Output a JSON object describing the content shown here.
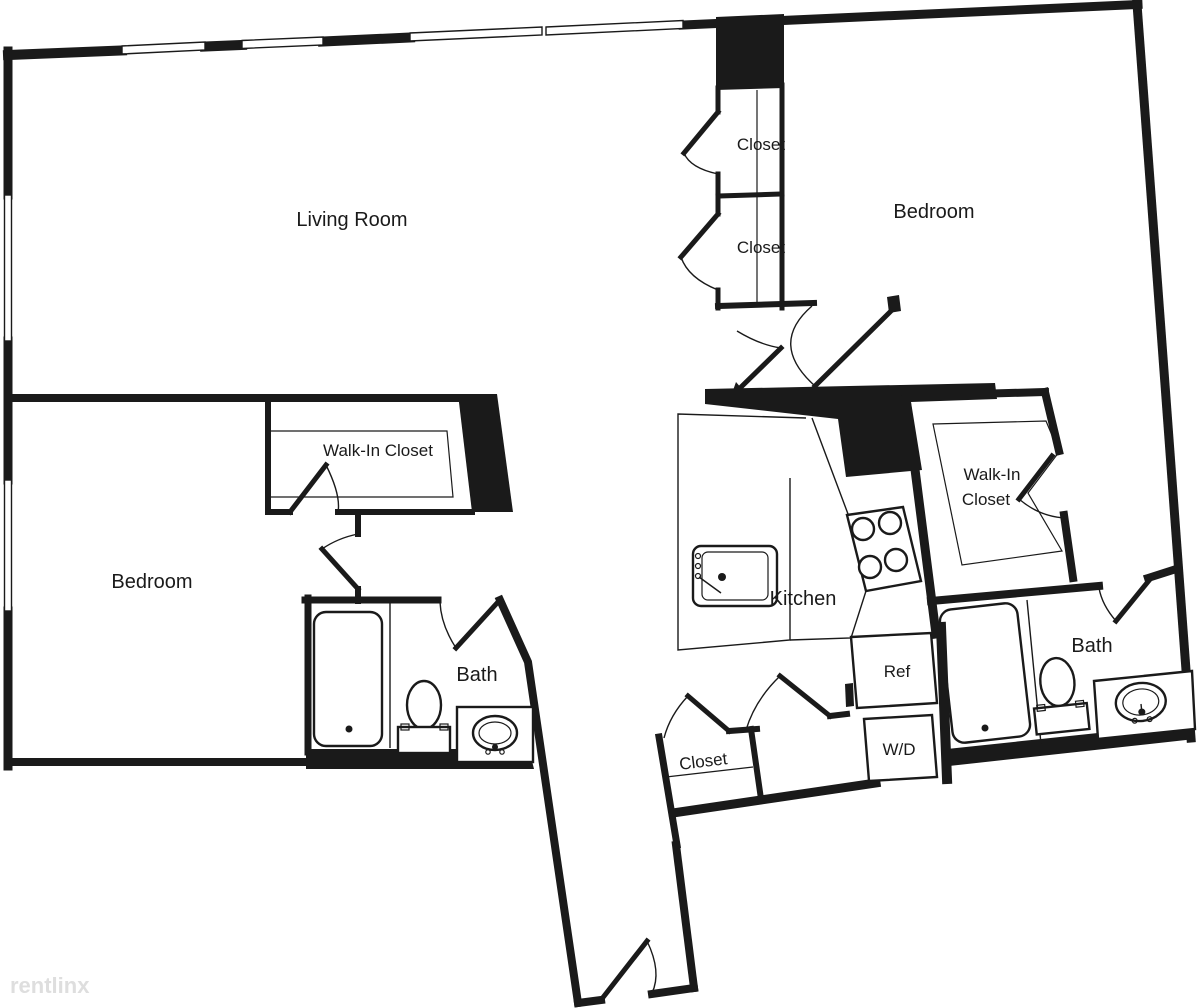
{
  "plan_title": "Two Bedroom Two Bath Floor Plan",
  "colors": {
    "wall": "#1a1a1a",
    "text": "#1a1a1a",
    "watermark": "#dedede",
    "background": "#ffffff"
  },
  "rooms": {
    "living_room": "Living Room",
    "bedroom_right": "Bedroom",
    "bedroom_left": "Bedroom",
    "closet_top_upper": "Closet",
    "closet_top_lower": "Closet",
    "walk_in_closet_left": "Walk-In Closet",
    "walk_in_closet_right_line1": "Walk-In",
    "walk_in_closet_right_line2": "Closet",
    "bath_left": "Bath",
    "bath_right": "Bath",
    "kitchen": "Kitchen",
    "closet_bottom": "Closet"
  },
  "appliances": {
    "refrigerator": "Ref",
    "washer_dryer": "W/D"
  },
  "watermark": "rentlinx"
}
